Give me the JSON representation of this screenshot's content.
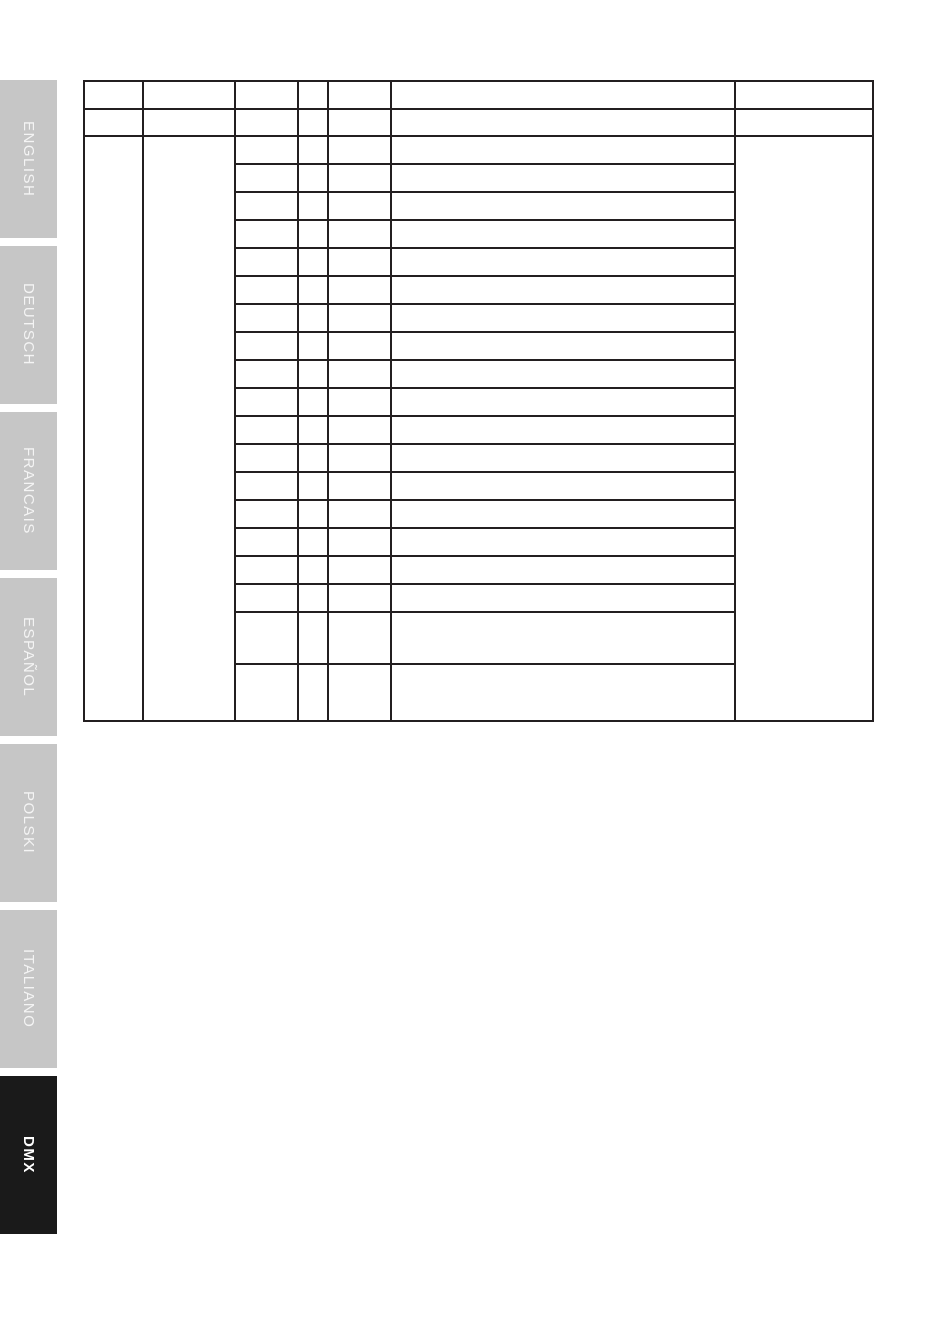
{
  "page": {
    "background": "#ffffff"
  },
  "sidebar": {
    "tabs": [
      {
        "label": "ENGLISH",
        "active": false
      },
      {
        "label": "DEUTSCH",
        "active": false
      },
      {
        "label": "FRANCAIS",
        "active": false
      },
      {
        "label": "ESPAÑOL",
        "active": false
      },
      {
        "label": "POLSKI",
        "active": false
      },
      {
        "label": "ITALIANO",
        "active": false
      },
      {
        "label": "DMX",
        "active": true
      }
    ],
    "colors": {
      "inactive_bg": "#c6c6c6",
      "active_bg": "#1a1a1a",
      "label": "#f4f4f4"
    }
  },
  "table": {
    "border_color": "#231f20",
    "column_widths": [
      59,
      92,
      63,
      30,
      63,
      344,
      138
    ],
    "header_row_heights": [
      28,
      27
    ],
    "sub_row_heights": [
      28,
      28,
      28,
      28,
      28,
      28,
      28,
      28,
      28,
      28,
      28,
      28,
      28,
      28,
      28,
      28,
      28,
      52,
      57
    ],
    "cells_empty": true
  }
}
